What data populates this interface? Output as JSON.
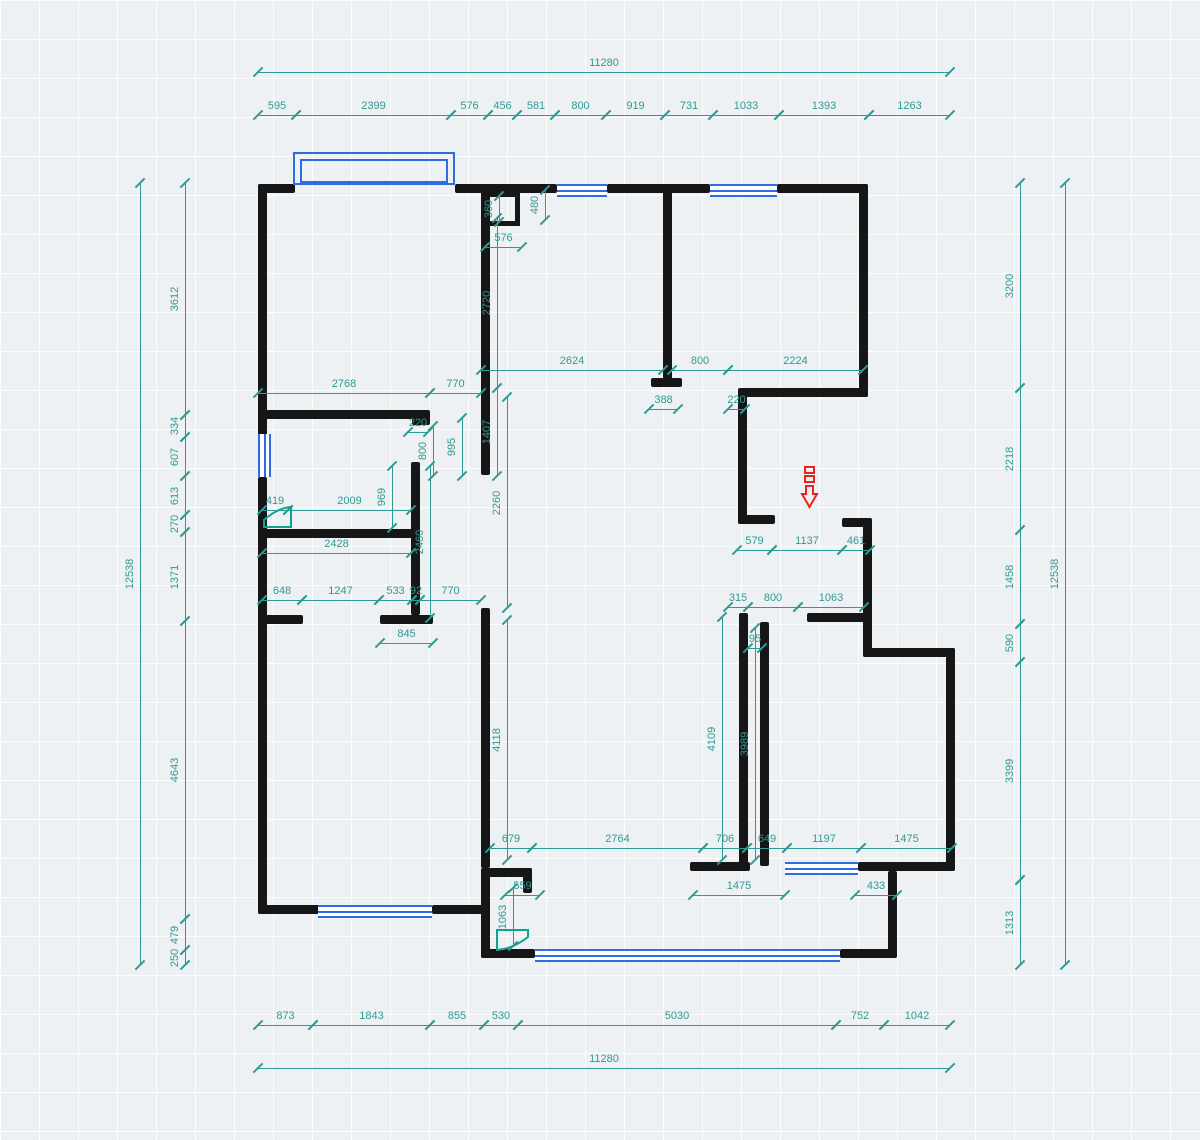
{
  "title": "floor-plan-drawing",
  "colors": {
    "wall": "#161616",
    "window": "#2e6ce2",
    "dimension": "#2f9a93",
    "entry_arrow": "#e8251c",
    "door_symbol": "#12a093",
    "background": "#eef1f3"
  },
  "canvas": {
    "width": 1200,
    "height": 1140
  },
  "walls": [
    [
      258,
      184,
      37,
      9
    ],
    [
      455,
      184,
      102,
      9
    ],
    [
      607,
      184,
      103,
      9
    ],
    [
      777,
      184,
      91,
      9
    ],
    [
      258,
      184,
      9,
      253
    ],
    [
      258,
      477,
      9,
      437
    ],
    [
      258,
      905,
      62,
      9
    ],
    [
      432,
      905,
      58,
      9
    ],
    [
      859,
      184,
      9,
      213
    ],
    [
      741,
      388,
      127,
      9
    ],
    [
      738,
      388,
      9,
      136
    ],
    [
      738,
      515,
      37,
      9
    ],
    [
      842,
      518,
      30,
      9
    ],
    [
      863,
      518,
      9,
      139
    ],
    [
      863,
      648,
      92,
      9
    ],
    [
      946,
      648,
      9,
      223
    ],
    [
      690,
      862,
      60,
      9
    ],
    [
      858,
      862,
      97,
      9
    ],
    [
      888,
      871,
      9,
      87
    ],
    [
      481,
      949,
      54,
      9
    ],
    [
      840,
      949,
      57,
      9
    ],
    [
      481,
      868,
      9,
      90
    ],
    [
      481,
      868,
      51,
      9
    ],
    [
      523,
      868,
      9,
      25
    ],
    [
      663,
      190,
      9,
      190
    ],
    [
      651,
      378,
      31,
      9
    ],
    [
      481,
      190,
      9,
      285
    ],
    [
      258,
      410,
      172,
      9
    ],
    [
      412,
      417,
      18,
      8
    ],
    [
      411,
      462,
      9,
      153
    ],
    [
      262,
      529,
      155,
      9
    ],
    [
      258,
      615,
      45,
      9
    ],
    [
      380,
      615,
      53,
      9
    ],
    [
      481,
      608,
      9,
      260
    ],
    [
      739,
      613,
      9,
      253
    ],
    [
      760,
      622,
      9,
      244
    ],
    [
      807,
      613,
      65,
      9
    ]
  ],
  "shaft_box": [
    484,
    192,
    36,
    34
  ],
  "bay_window": {
    "outer": [
      293,
      152,
      162,
      33
    ],
    "inner": [
      300,
      159,
      148,
      24
    ]
  },
  "windows": [
    {
      "rect": [
        557,
        184,
        50,
        9
      ],
      "orient": "h"
    },
    {
      "rect": [
        710,
        184,
        67,
        9
      ],
      "orient": "h"
    },
    {
      "rect": [
        258,
        434,
        9,
        43
      ],
      "orient": "v"
    },
    {
      "rect": [
        318,
        905,
        114,
        9
      ],
      "orient": "h"
    },
    {
      "rect": [
        785,
        862,
        73,
        9
      ],
      "orient": "h"
    },
    {
      "rect": [
        535,
        949,
        305,
        9
      ],
      "orient": "h"
    }
  ],
  "dims_h": [
    {
      "label": "11280",
      "x1": 258,
      "x2": 950,
      "y": 72
    },
    {
      "label": "595",
      "x1": 258,
      "x2": 296,
      "y": 115
    },
    {
      "label": "2399",
      "x1": 296,
      "x2": 451,
      "y": 115
    },
    {
      "label": "576",
      "x1": 451,
      "x2": 488,
      "y": 115
    },
    {
      "label": "456",
      "x1": 488,
      "x2": 517,
      "y": 115
    },
    {
      "label": "581",
      "x1": 517,
      "x2": 555,
      "y": 115
    },
    {
      "label": "800",
      "x1": 555,
      "x2": 606,
      "y": 115
    },
    {
      "label": "919",
      "x1": 606,
      "x2": 665,
      "y": 115
    },
    {
      "label": "731",
      "x1": 665,
      "x2": 713,
      "y": 115
    },
    {
      "label": "1033",
      "x1": 713,
      "x2": 779,
      "y": 115
    },
    {
      "label": "1393",
      "x1": 779,
      "x2": 869,
      "y": 115
    },
    {
      "label": "1263",
      "x1": 869,
      "x2": 950,
      "y": 115
    },
    {
      "label": "576",
      "x1": 485,
      "x2": 522,
      "y": 247
    },
    {
      "label": "2624",
      "x1": 481,
      "x2": 663,
      "y": 370
    },
    {
      "label": "800",
      "x1": 672,
      "x2": 728,
      "y": 370
    },
    {
      "label": "2224",
      "x1": 728,
      "x2": 863,
      "y": 370
    },
    {
      "label": "2768",
      "x1": 258,
      "x2": 430,
      "y": 393
    },
    {
      "label": "770",
      "x1": 430,
      "x2": 481,
      "y": 393
    },
    {
      "label": "388",
      "x1": 649,
      "x2": 678,
      "y": 409
    },
    {
      "label": "220",
      "x1": 728,
      "x2": 745,
      "y": 409
    },
    {
      "label": "220",
      "x1": 408,
      "x2": 428,
      "y": 432
    },
    {
      "label": "419",
      "x1": 262,
      "x2": 288,
      "y": 510
    },
    {
      "label": "2009",
      "x1": 288,
      "x2": 411,
      "y": 510
    },
    {
      "label": "2428",
      "x1": 262,
      "x2": 411,
      "y": 553
    },
    {
      "label": "579",
      "x1": 737,
      "x2": 772,
      "y": 550
    },
    {
      "label": "1137",
      "x1": 772,
      "x2": 842,
      "y": 550
    },
    {
      "label": "461",
      "x1": 842,
      "x2": 870,
      "y": 550
    },
    {
      "label": "648",
      "x1": 262,
      "x2": 302,
      "y": 600
    },
    {
      "label": "1247",
      "x1": 302,
      "x2": 379,
      "y": 600
    },
    {
      "label": "533",
      "x1": 379,
      "x2": 412,
      "y": 600
    },
    {
      "label": "92",
      "x1": 412,
      "x2": 420,
      "y": 600
    },
    {
      "label": "770",
      "x1": 420,
      "x2": 481,
      "y": 600
    },
    {
      "label": "315",
      "x1": 728,
      "x2": 748,
      "y": 607
    },
    {
      "label": "800",
      "x1": 748,
      "x2": 798,
      "y": 607
    },
    {
      "label": "1063",
      "x1": 798,
      "x2": 864,
      "y": 607
    },
    {
      "label": "845",
      "x1": 380,
      "x2": 433,
      "y": 643
    },
    {
      "label": "95",
      "x1": 748,
      "x2": 762,
      "y": 648
    },
    {
      "label": "679",
      "x1": 490,
      "x2": 532,
      "y": 848
    },
    {
      "label": "2764",
      "x1": 532,
      "x2": 703,
      "y": 848
    },
    {
      "label": "706",
      "x1": 703,
      "x2": 747,
      "y": 848
    },
    {
      "label": "649",
      "x1": 747,
      "x2": 787,
      "y": 848
    },
    {
      "label": "1197",
      "x1": 787,
      "x2": 861,
      "y": 848
    },
    {
      "label": "1475",
      "x1": 861,
      "x2": 952,
      "y": 848
    },
    {
      "label": "559",
      "x1": 505,
      "x2": 540,
      "y": 895
    },
    {
      "label": "1475",
      "x1": 693,
      "x2": 785,
      "y": 895
    },
    {
      "label": "433",
      "x1": 855,
      "x2": 897,
      "y": 895
    },
    {
      "label": "873",
      "x1": 258,
      "x2": 313,
      "y": 1025
    },
    {
      "label": "1843",
      "x1": 313,
      "x2": 430,
      "y": 1025
    },
    {
      "label": "855",
      "x1": 430,
      "x2": 484,
      "y": 1025
    },
    {
      "label": "530",
      "x1": 484,
      "x2": 518,
      "y": 1025
    },
    {
      "label": "5030",
      "x1": 518,
      "x2": 836,
      "y": 1025
    },
    {
      "label": "752",
      "x1": 836,
      "x2": 884,
      "y": 1025
    },
    {
      "label": "1042",
      "x1": 884,
      "x2": 950,
      "y": 1025
    },
    {
      "label": "11280",
      "x1": 258,
      "x2": 950,
      "y": 1068
    }
  ],
  "dims_v": [
    {
      "label": "12538",
      "x": 140,
      "y1": 183,
      "y2": 965
    },
    {
      "label": "3612",
      "x": 185,
      "y1": 183,
      "y2": 415
    },
    {
      "label": "334",
      "x": 185,
      "y1": 415,
      "y2": 437
    },
    {
      "label": "607",
      "x": 185,
      "y1": 437,
      "y2": 476
    },
    {
      "label": "613",
      "x": 185,
      "y1": 476,
      "y2": 515
    },
    {
      "label": "270",
      "x": 185,
      "y1": 515,
      "y2": 532
    },
    {
      "label": "1371",
      "x": 185,
      "y1": 532,
      "y2": 621
    },
    {
      "label": "4643",
      "x": 185,
      "y1": 621,
      "y2": 919
    },
    {
      "label": "479",
      "x": 185,
      "y1": 919,
      "y2": 950
    },
    {
      "label": "250",
      "x": 185,
      "y1": 950,
      "y2": 965
    },
    {
      "label": "3200",
      "x": 1020,
      "y1": 183,
      "y2": 388
    },
    {
      "label": "2218",
      "x": 1020,
      "y1": 388,
      "y2": 530
    },
    {
      "label": "1458",
      "x": 1020,
      "y1": 530,
      "y2": 624
    },
    {
      "label": "590",
      "x": 1020,
      "y1": 624,
      "y2": 662
    },
    {
      "label": "3399",
      "x": 1020,
      "y1": 662,
      "y2": 880
    },
    {
      "label": "1313",
      "x": 1020,
      "y1": 880,
      "y2": 965
    },
    {
      "label": "12538",
      "x": 1065,
      "y1": 183,
      "y2": 965
    },
    {
      "label": "360",
      "x": 499,
      "y1": 196,
      "y2": 222
    },
    {
      "label": "480",
      "x": 545,
      "y1": 190,
      "y2": 220
    },
    {
      "label": "2720",
      "x": 497,
      "y1": 218,
      "y2": 388
    },
    {
      "label": "1407",
      "x": 497,
      "y1": 388,
      "y2": 476
    },
    {
      "label": "995",
      "x": 462,
      "y1": 418,
      "y2": 476
    },
    {
      "label": "800",
      "x": 433,
      "y1": 426,
      "y2": 476
    },
    {
      "label": "2260",
      "x": 507,
      "y1": 397,
      "y2": 608
    },
    {
      "label": "969",
      "x": 392,
      "y1": 466,
      "y2": 528
    },
    {
      "label": "2460",
      "x": 430,
      "y1": 466,
      "y2": 618
    },
    {
      "label": "4118",
      "x": 507,
      "y1": 620,
      "y2": 860
    },
    {
      "label": "1063",
      "x": 513,
      "y1": 888,
      "y2": 946
    },
    {
      "label": "4109",
      "x": 722,
      "y1": 617,
      "y2": 860
    },
    {
      "label": "3989",
      "x": 755,
      "y1": 628,
      "y2": 860
    }
  ],
  "entry_arrow": {
    "x": 800,
    "y": 466,
    "w": 20,
    "h": 48
  },
  "door_symbols": [
    {
      "x": 263,
      "y": 506,
      "w": 29,
      "h": 22,
      "dir": "up-right"
    },
    {
      "x": 496,
      "y": 929,
      "w": 33,
      "h": 22,
      "dir": "down-left"
    }
  ]
}
